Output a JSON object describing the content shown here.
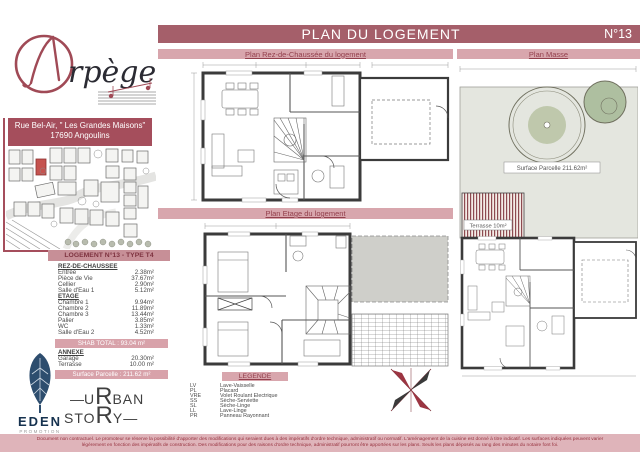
{
  "header": {
    "title": "PLAN DU LOGEMENT",
    "number": "N°13"
  },
  "bars": {
    "rdc": "Plan Rez-de-Chaussée du logement",
    "masse": "Plan Masse",
    "etage": "Plan Etage du logement",
    "legende": "LEGENDE"
  },
  "brand": {
    "name": "Arpège",
    "logo_script": "rpège",
    "address_line1": "Rue Bel-Air, \" Les Grandes Maisons\"",
    "address_line2": "17690 Angoulins"
  },
  "table": {
    "title": "LOGEMENT N°13 - TYPE T4",
    "sections": [
      {
        "name": "REZ-DE-CHAUSSEE",
        "rows": [
          [
            "Entrée",
            "2.38m²"
          ],
          [
            "Pièce de Vie",
            "37.67m²"
          ],
          [
            "Cellier",
            "2.90m²"
          ],
          [
            "Salle d'Eau 1",
            "5.12m²"
          ]
        ]
      },
      {
        "name": "ETAGE",
        "rows": [
          [
            "Chambre 1",
            "9.94m²"
          ],
          [
            "Chambre 2",
            "11.89m²"
          ],
          [
            "Chambre 3",
            "13.44m²"
          ],
          [
            "Palier",
            "3.85m²"
          ],
          [
            "WC",
            "1.33m²"
          ],
          [
            "Salle d'Eau 2",
            "4.52m²"
          ]
        ]
      }
    ],
    "shab_total": "SHAB TOTAL : 93.04 m²",
    "annexe": {
      "name": "ANNEXE",
      "rows": [
        [
          "Garage",
          "20.30m²"
        ],
        [
          "Terrasse",
          "10.00 m²"
        ]
      ]
    },
    "surface_parcelle": "Surface Parcelle : 211.62 m²"
  },
  "legend": {
    "items": [
      [
        "LV",
        "Lave-Vaisselle"
      ],
      [
        "PL",
        "Placard"
      ],
      [
        "VRE",
        "Volet Roulant Electrique"
      ],
      [
        "SS",
        "Sèche-Serviette"
      ],
      [
        "SL",
        "Sèche-Linge"
      ],
      [
        "LL",
        "Lave-Linge"
      ],
      [
        "PR",
        "Panneau Rayonnant"
      ]
    ]
  },
  "plan_masse": {
    "surface_label": "Surface Parcelle 211.62m²",
    "terrasse_label": "Terrasse 10m²"
  },
  "logos": {
    "eden": "EDEN",
    "eden_sub": "PROMOTION",
    "urban_u": "U",
    "urban_r1": "R",
    "urban_ban": "BAN",
    "urban_sto": "STO",
    "urban_r2": "R",
    "urban_y": "Y"
  },
  "disclaimer": {
    "line1": "Document non contractuel. Le promoteur se réserve la possibilité d'apporter des modifications qui seraient dues à des impératifs d'ordre technique, administratif ou normatif. L'aménagement de la cuisine est donné à titre indicatif. Les surfaces indiquées peuvent varier",
    "line2": "légèrement en fonction des impératifs de construction. Des modifications pour des raisons d'ordre technique, administratif pourront être apportées sur les plans. Seuls les plans déposés au rang des minutes du notaire font foi."
  },
  "colors": {
    "bar_dark": "#a55f6a",
    "bar_light": "#d8a6ad",
    "bar_text": "#93404d",
    "accent_red": "#a04a56",
    "table_head": "#c78f97",
    "eden_navy": "#27496b",
    "disclaimer_bg": "#dfb4ba",
    "parcel_green": "#e4e6df"
  }
}
